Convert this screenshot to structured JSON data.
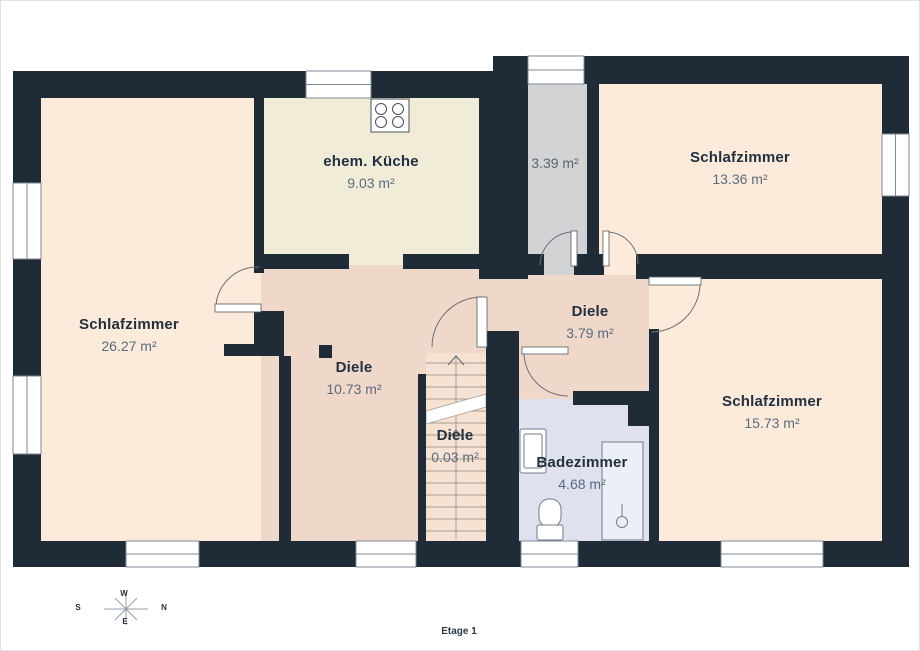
{
  "page": {
    "floor_label": "Etage 1"
  },
  "compass": {
    "w": "W",
    "n": "N",
    "s": "S",
    "e": "E"
  },
  "rooms": [
    {
      "id": "schlafzimmer-links",
      "name": "Schlafzimmer",
      "area": "26.27 m²"
    },
    {
      "id": "ehem-kueche",
      "name": "ehem. Küche",
      "area": "9.03 m²"
    },
    {
      "id": "abstellraum",
      "name": "",
      "area": "3.39 m²"
    },
    {
      "id": "schlafzimmer-oben",
      "name": "Schlafzimmer",
      "area": "13.36 m²"
    },
    {
      "id": "diele-gross",
      "name": "Diele",
      "area": "10.73 m²"
    },
    {
      "id": "diele-mitte",
      "name": "Diele",
      "area": "3.79 m²"
    },
    {
      "id": "diele-treppe",
      "name": "Diele",
      "area": "0.03 m²"
    },
    {
      "id": "badezimmer",
      "name": "Badezimmer",
      "area": "4.68 m²"
    },
    {
      "id": "schlafzimmer-unten",
      "name": "Schlafzimmer",
      "area": "15.73 m²"
    }
  ],
  "colors": {
    "wall": "#202b38",
    "bedroom_floor": "#fcebda",
    "kitchen_floor": "#f1ecd8",
    "hallway_floor": "#efd8c9",
    "stairs_floor": "#f6e2d3",
    "storage_floor": "#d2d3d5",
    "bathroom_floor": "#dfe2ee",
    "room_name_text": "#22303f",
    "room_area_text": "#5a6b7d"
  }
}
